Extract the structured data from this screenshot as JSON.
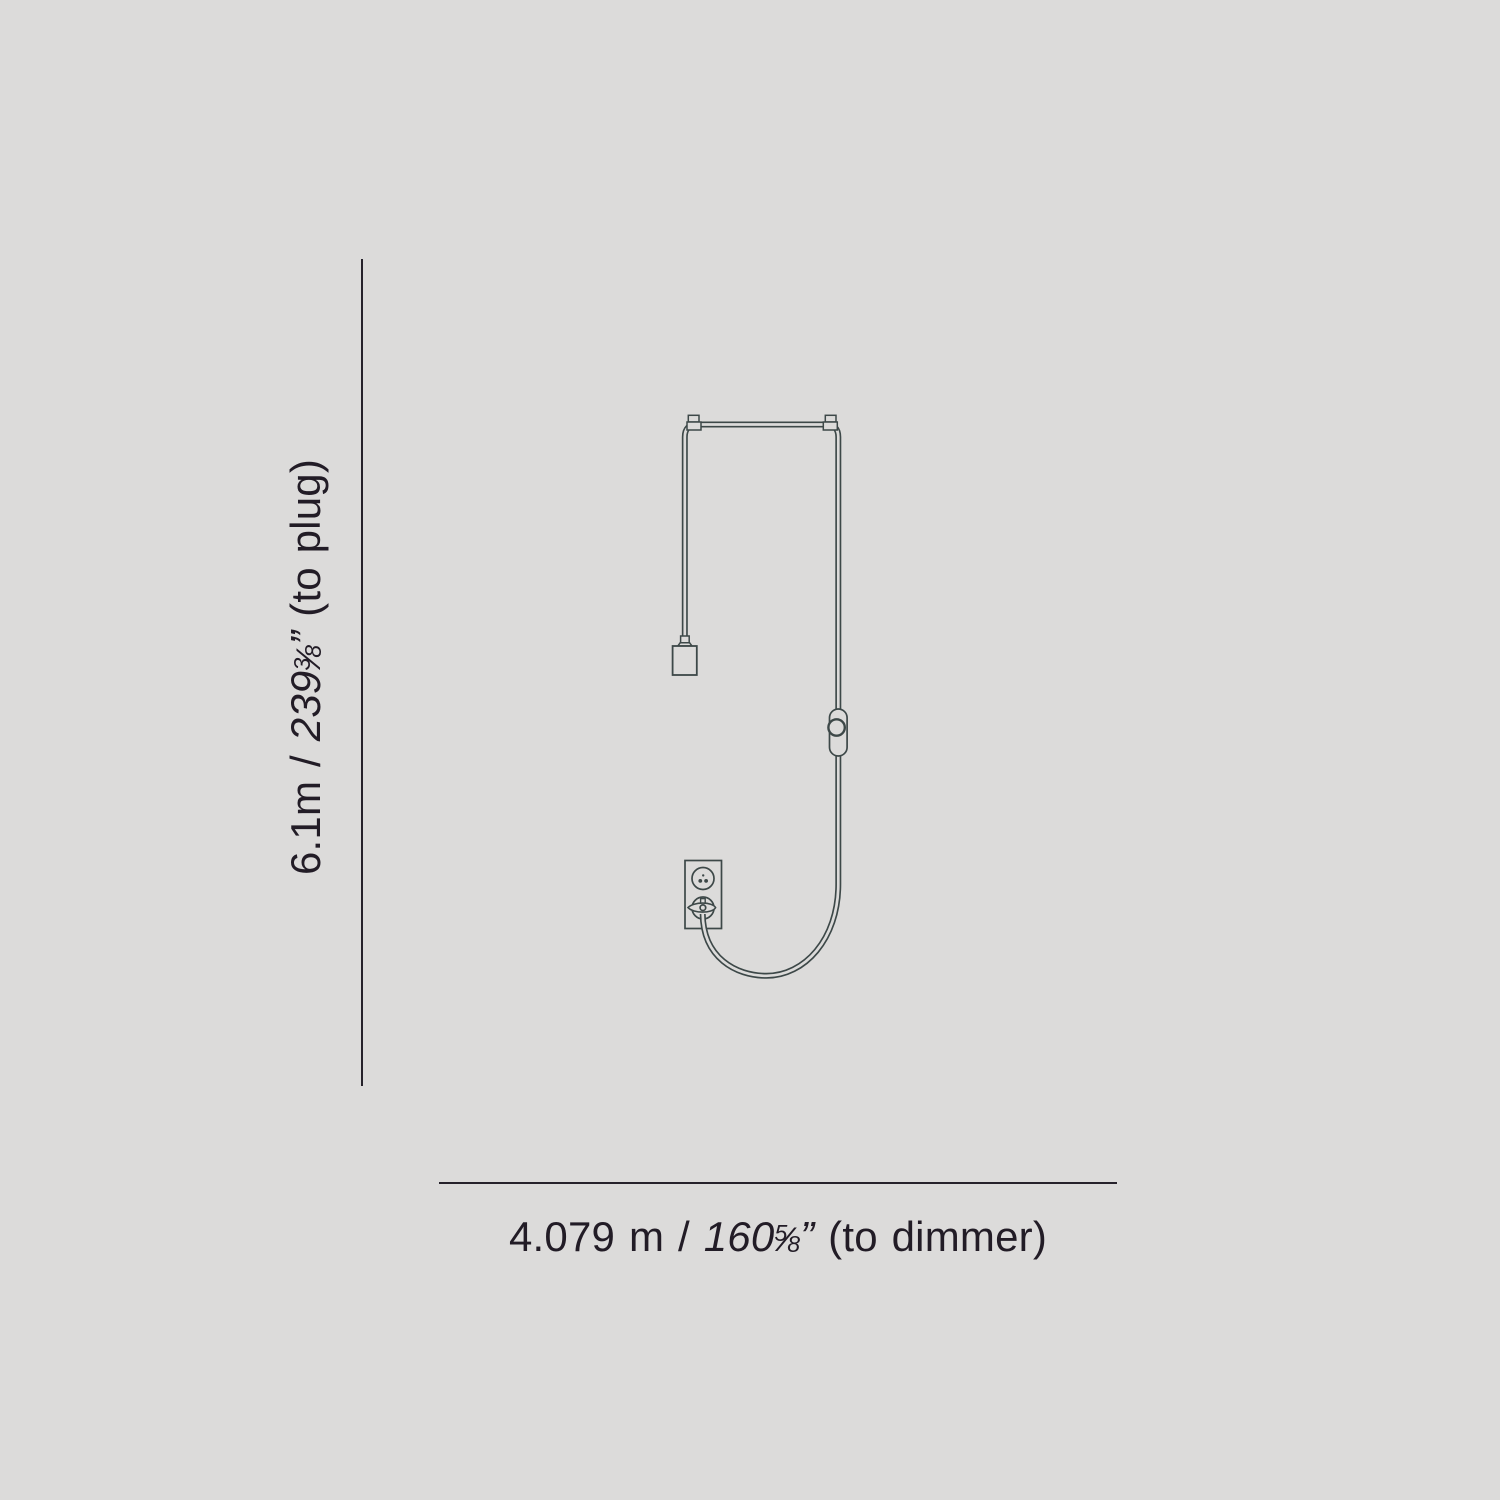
{
  "colors": {
    "background": "#dcdbda",
    "drawing_line": "#3d4848",
    "dimension_line": "#26222b",
    "text": "#221c26"
  },
  "dimension_vertical": {
    "metric": "6.1m / ",
    "imperial_whole": "239",
    "frac_num": "3",
    "frac_slash": "⁄",
    "frac_den": "8",
    "quote": "”",
    "suffix": " (to plug)"
  },
  "dimension_horizontal": {
    "metric": "4.079 m / ",
    "imperial_whole": "160",
    "frac_num": "5",
    "frac_slash": "⁄",
    "frac_den": "8",
    "quote": "”",
    "suffix": " (to dimmer)"
  },
  "drawing": {
    "parts": [
      "power-cord",
      "cable-clip-left",
      "cable-clip-right",
      "lamp-socket",
      "inline-dimmer",
      "wall-outlet",
      "power-plug"
    ]
  }
}
